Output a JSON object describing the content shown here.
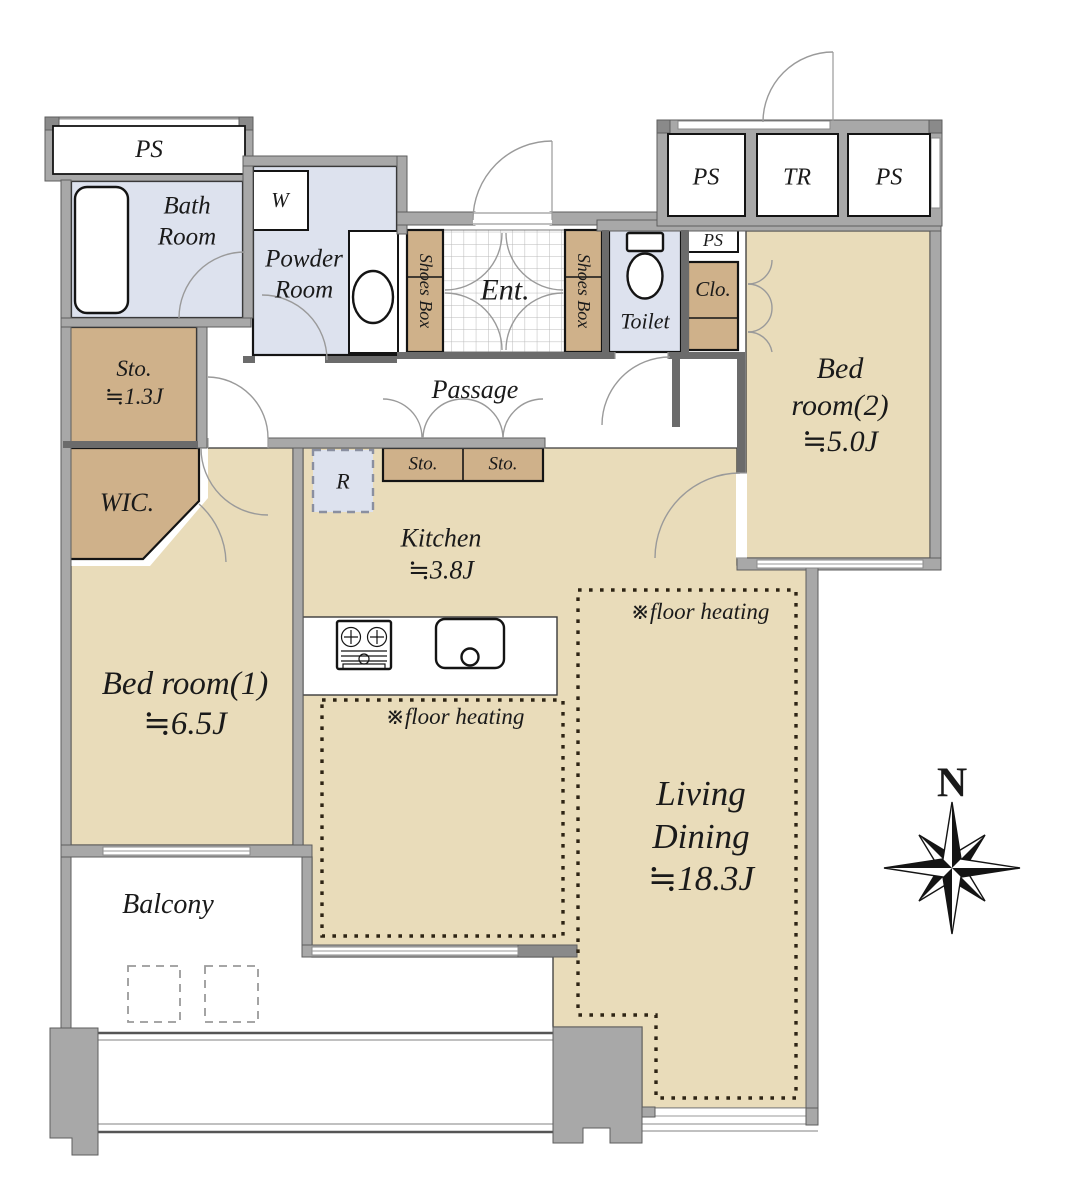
{
  "plan": {
    "labels": {
      "ps_top_left": "PS",
      "bath": "Bath\nRoom",
      "washer": "W",
      "powder": "Powder\nRoom",
      "shoes_box_left": "Shoes Box",
      "entrance": "Ent.",
      "shoes_box_right": "Shoes Box",
      "toilet": "Toilet",
      "ps_small": "PS",
      "closet": "Clo.",
      "ps_block_left": "PS",
      "trunk": "TR",
      "ps_block_right": "PS",
      "bedroom2": "Bed\nroom(2)\n≒5.0J",
      "storage13": "Sto.\n≒1.3J",
      "passage": "Passage",
      "wic": "WIC.",
      "refrigerator": "R",
      "storage_a": "Sto.",
      "storage_b": "Sto.",
      "kitchen": "Kitchen\n≒3.8J",
      "floor_heating_kitchen": "※floor heating",
      "floor_heating_living": "※floor heating",
      "bedroom1": "Bed room(1)\n≒6.5J",
      "living_dining": "Living\nDining\n≒18.3J",
      "balcony": "Balcony",
      "compass_north": "N"
    },
    "colors": {
      "room-tan": "#e9dcba",
      "cabinet-tan": "#cfb18a",
      "wet-blue": "#dde2ee",
      "wall-gray": "#a8a8a8",
      "dark-line": "#1a1a1a"
    }
  }
}
